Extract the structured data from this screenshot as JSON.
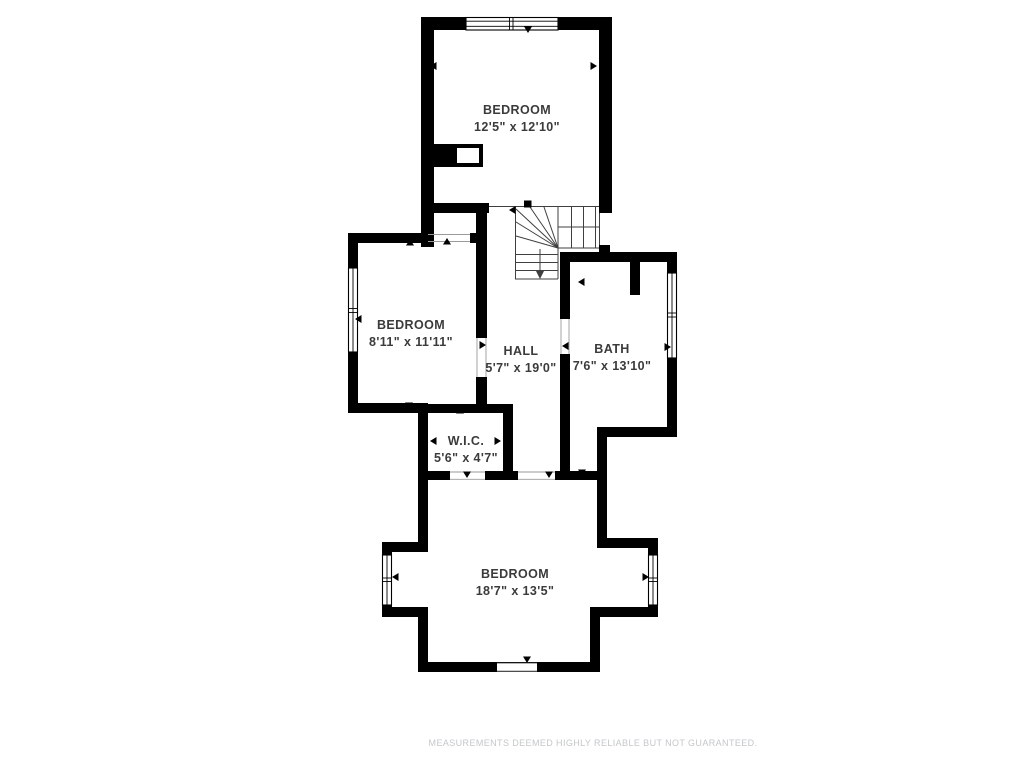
{
  "colors": {
    "background": "#ffffff",
    "wall": "#000000",
    "label": "#3b3b3b",
    "stair_line": "#3f3f3f",
    "disclaimer": "#c4c7c9"
  },
  "rooms": [
    {
      "id": "bedroom-top",
      "name": "BEDROOM",
      "dims": "12'5\" x 12'10\""
    },
    {
      "id": "bedroom-left",
      "name": "BEDROOM",
      "dims": "8'11\" x 11'11\""
    },
    {
      "id": "hall",
      "name": "HALL",
      "dims": "5'7\" x 19'0\""
    },
    {
      "id": "bath",
      "name": "BATH",
      "dims": "7'6\" x 13'10\""
    },
    {
      "id": "wic",
      "name": "W.I.C.",
      "dims": "5'6\" x 4'7\""
    },
    {
      "id": "bedroom-bottom",
      "name": "BEDROOM",
      "dims": "18'7\" x 13'5\""
    }
  ],
  "stairs": {
    "direction": "down"
  },
  "disclaimer": "MEASUREMENTS DEEMED HIGHLY RELIABLE BUT NOT GUARANTEED."
}
